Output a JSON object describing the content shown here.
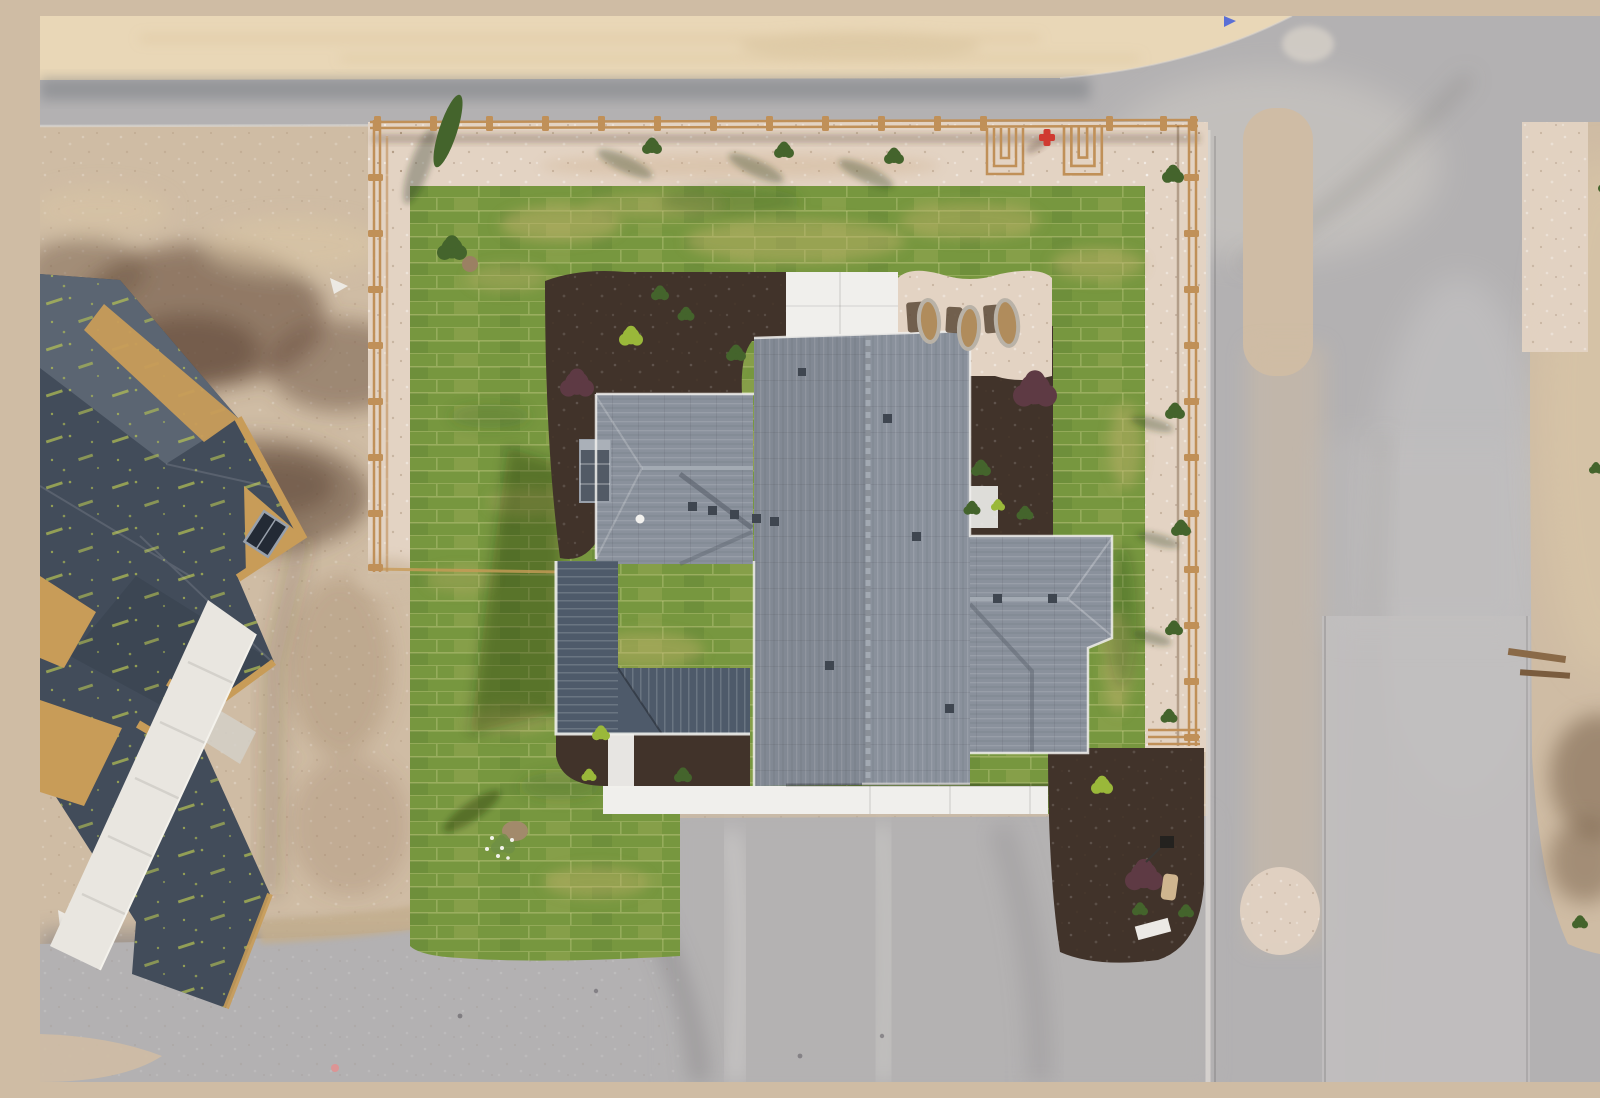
{
  "scene": {
    "description": "Aerial drone view straight down on a newly built single-family house with a gray shingle roof, dark metal porch roof, fresh sod lawn laid in a brick pattern, pink gravel borders with a split-rail wood fence, dark mulch planting beds with shrubs, three oval window-well covers, a red fire hydrant at the street, surrounding gray asphalt roads with a dirt median strip, bare construction dirt, and a second house under construction at the left with dark printed roofing underlayment and exposed OSB edges.",
    "type": "aerial-photo",
    "objects": {
      "main_house": "new home with asphalt-shingle hip/gable roof, chimney, metal porch roof, white concrete patio, walkway and apron",
      "construction_house": "framed house with dark synthetic underlayment (lime print marks) and tan OSB fascia, concrete sidewalk",
      "lawn": "fresh sod squares, green with yellow strips",
      "fence": "split-rail wooden fence on three sides of the lot with small shrubs and trees",
      "window_well_covers": 3,
      "fire_hydrant": 1,
      "yard_sign": 1,
      "utility_box": 1,
      "roads": "asphalt street along top and right with tan dirt median and lighter concrete lane",
      "driveway": "gray graded driveway at bottom center with tire marks"
    }
  },
  "palette": {
    "sand_top": "#e9d7b7",
    "dirt_light": "#cfbca4",
    "dirt_dark": "#7c6450",
    "mud": "#6b5140",
    "road": "#b3b1b2",
    "road_dark": "#77757a",
    "road_light": "#c2c0bf",
    "curb": "#d9d6d1",
    "gravel": "#e3d3c3",
    "lawn": "#77973f",
    "lawn_yellow": "#c2b16c",
    "mulch": "#41332a",
    "shingle": "#8a919c",
    "shingle_dark": "#5e6570",
    "ridge": "#a3aab3",
    "metal_roof": "#4e5a6a",
    "concrete_white": "#f0efec",
    "osb": "#c89c58",
    "underlayment": "#424c5a",
    "speckle": "#b9c653",
    "fence": "#c09058",
    "shrub_green": "#44642c",
    "shrub_lime": "#9ab83a",
    "shrub_purple": "#5e3a44",
    "hydrant_red": "#d03a30",
    "pond_teal": "#3f9fae",
    "flag_blue": "#5a6fd6"
  }
}
